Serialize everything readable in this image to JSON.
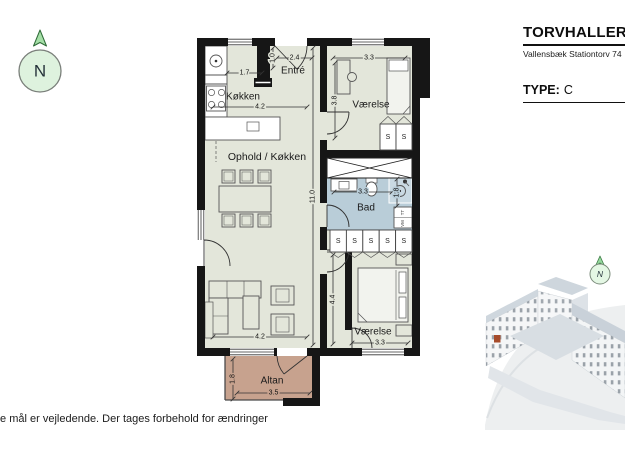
{
  "header": {
    "project_title": "TORVHALLERNE",
    "address": "Vallensbæk Stationtorv 74",
    "type_label": "TYPE:",
    "type_value": "C"
  },
  "compass": {
    "letter": "N"
  },
  "building_render": {
    "compass_letter": "N"
  },
  "floorplan": {
    "rooms": [
      {
        "id": "entre",
        "label": "Entré"
      },
      {
        "id": "kokken",
        "label": "Køkken"
      },
      {
        "id": "ophold-kokken",
        "label": "Ophold / Køkken"
      },
      {
        "id": "vaerelse-1",
        "label": "Værelse"
      },
      {
        "id": "bad",
        "label": "Bad"
      },
      {
        "id": "vaerelse-2",
        "label": "Værelse"
      },
      {
        "id": "altan",
        "label": "Altan"
      }
    ],
    "dimensions": [
      {
        "id": "kokken-depth",
        "value": "1.7"
      },
      {
        "id": "entre-depth",
        "value": "1.0"
      },
      {
        "id": "entre-width",
        "value": "2.4"
      },
      {
        "id": "kokken-width",
        "value": "4.2"
      },
      {
        "id": "vaerelse1-width",
        "value": "3.3"
      },
      {
        "id": "vaerelse1-depth",
        "value": "3.8"
      },
      {
        "id": "apartment-length",
        "value": "11.0"
      },
      {
        "id": "bad-width",
        "value": "3.3"
      },
      {
        "id": "bad-depth",
        "value": "1.8"
      },
      {
        "id": "hall-length",
        "value": "4.4"
      },
      {
        "id": "vaerelse2-width",
        "value": "3.3"
      },
      {
        "id": "ophold-width",
        "value": "4.2"
      },
      {
        "id": "altan-depth",
        "value": "1.8"
      },
      {
        "id": "altan-width",
        "value": "3.5"
      }
    ],
    "wardrobe_label": "S",
    "appliance_labels": {
      "dryer": "TT",
      "washer": "VM"
    }
  },
  "footer": {
    "disclaimer": "te mål er vejledende. Der tages forbehold for ændringer"
  },
  "colors": {
    "floor": "#e3e6da",
    "bathroom_floor": "#b9cdd8",
    "balcony_floor": "#c7a28e",
    "wall": "#161616",
    "compass_green": "#a5dfa7"
  }
}
